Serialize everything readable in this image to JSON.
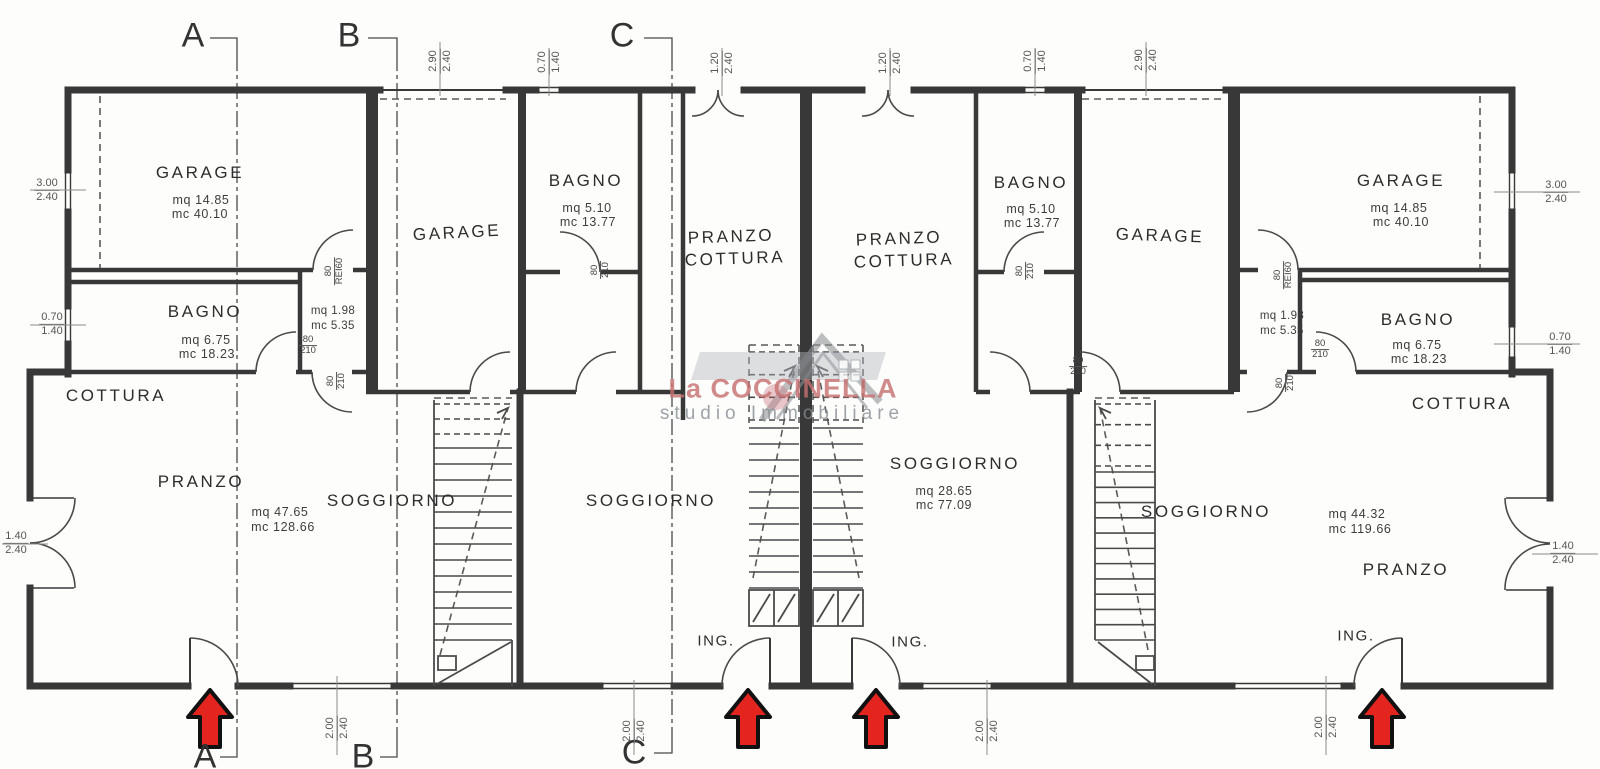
{
  "watermark": {
    "brand": "La COCCINELLA",
    "tagline": "studio Immobiliare"
  },
  "sections": {
    "a": "A",
    "b": "B",
    "c": "C"
  },
  "entrance_label": "ING.",
  "rooms": {
    "garage_1": {
      "name": "GARAGE",
      "area": "mq 14.85",
      "volume": "mc 40.10"
    },
    "bagno_1": {
      "name": "BAGNO",
      "area": "mq 6.75",
      "volume": "mc 18.23"
    },
    "wc_1": {
      "area": "mq 1.98",
      "volume": "mc 5.35"
    },
    "cottura_1": {
      "name": "COTTURA"
    },
    "pranzo_1": {
      "name": "PRANZO"
    },
    "soggiorno_1": {
      "name": "SOGGIORNO",
      "area": "mq 47.65",
      "volume": "mc 128.66"
    },
    "garage_2": {
      "name": "GARAGE"
    },
    "bagno_2": {
      "name": "BAGNO",
      "area": "mq 5.10",
      "volume": "mc 13.77"
    },
    "pranzo_cottura_2": {
      "line1": "PRANZO",
      "line2": "COTTURA"
    },
    "soggiorno_2": {
      "name": "SOGGIORNO"
    },
    "pranzo_cottura_3": {
      "line1": "PRANZO",
      "line2": "COTTURA"
    },
    "bagno_3": {
      "name": "BAGNO",
      "area": "mq 5.10",
      "volume": "mc 13.77"
    },
    "garage_3": {
      "name": "GARAGE"
    },
    "soggiorno_3": {
      "name": "SOGGIORNO",
      "area": "mq 28.65",
      "volume": "mc 77.09"
    },
    "garage_4": {
      "name": "GARAGE",
      "area": "mq 14.85",
      "volume": "mc 40.10"
    },
    "bagno_4": {
      "name": "BAGNO",
      "area": "mq 6.75",
      "volume": "mc 18.23"
    },
    "wc_4": {
      "area": "mq 1.98",
      "volume": "mc 5.35"
    },
    "cottura_4": {
      "name": "COTTURA"
    },
    "pranzo_4": {
      "name": "PRANZO"
    },
    "soggiorno_4": {
      "name": "SOGGIORNO",
      "area": "mq 44.32",
      "volume": "mc 119.66"
    }
  },
  "dimensions": {
    "top": [
      {
        "w": "2.90",
        "h": "2.40"
      },
      {
        "w": "0.70",
        "h": "1.40"
      },
      {
        "w": "1.20",
        "h": "2.40"
      },
      {
        "w": "1.20",
        "h": "2.40"
      },
      {
        "w": "0.70",
        "h": "1.40"
      },
      {
        "w": "2.90",
        "h": "2.40"
      }
    ],
    "bottom": [
      {
        "w": "2.00",
        "h": "2.40"
      },
      {
        "w": "2.00",
        "h": "2.40"
      },
      {
        "w": "2.00",
        "h": "2.40"
      },
      {
        "w": "2.00",
        "h": "2.40"
      }
    ],
    "left": [
      {
        "w": "3.00",
        "h": "2.40"
      },
      {
        "w": "0.70",
        "h": "1.40"
      },
      {
        "w": "1.40",
        "h": "2.40"
      }
    ],
    "right": [
      {
        "w": "3.00",
        "h": "2.40"
      },
      {
        "w": "0.70",
        "h": "1.40"
      },
      {
        "w": "1.40",
        "h": "2.40"
      }
    ]
  },
  "door_tags": {
    "standard": {
      "w": "80",
      "h": "210"
    },
    "fire": {
      "w": "80",
      "h": "REI60"
    }
  },
  "colors": {
    "arrow": "#e3241f",
    "walls": "#383838"
  }
}
